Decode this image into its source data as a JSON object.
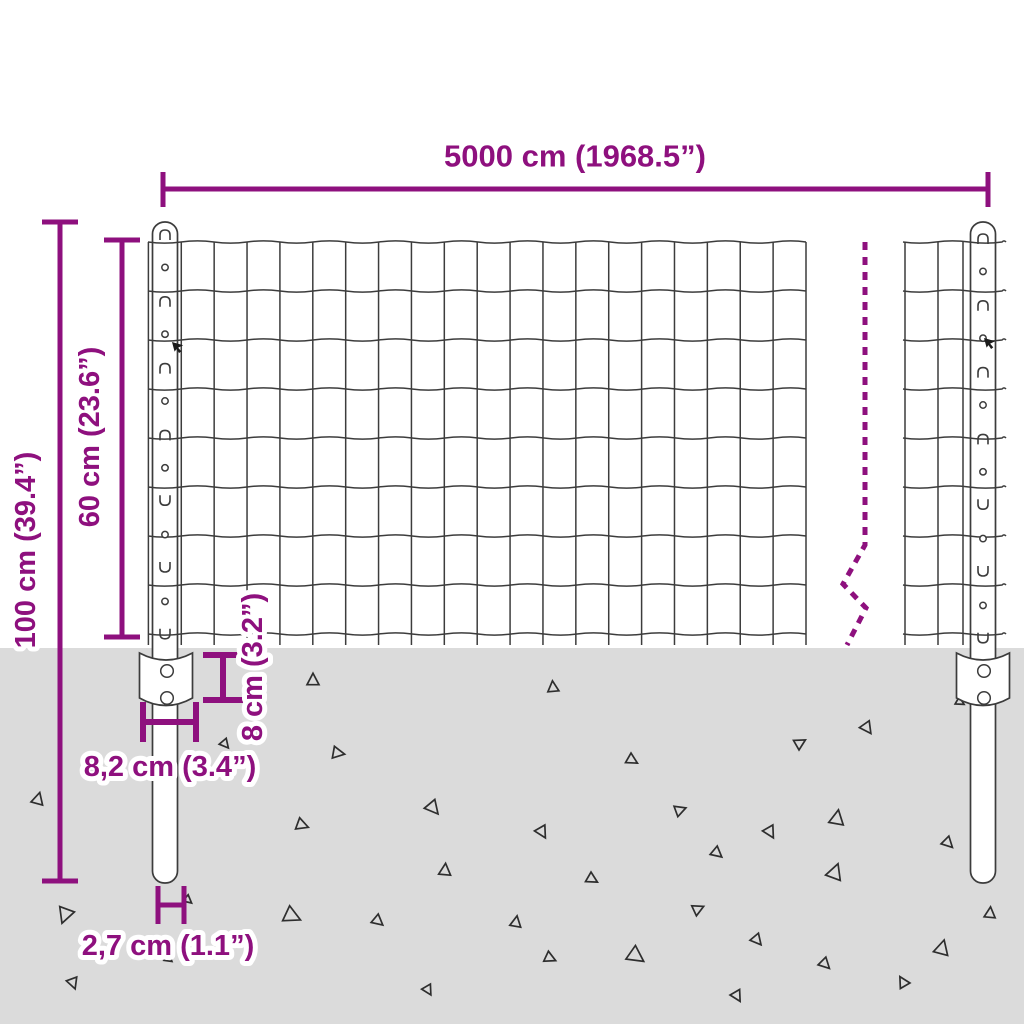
{
  "diagram": {
    "title": "Fence panel with posts — dimension diagram",
    "labels": {
      "width": "5000 cm (1968.5”)",
      "total_height": "100 cm (39.4”)",
      "panel_height": "60 cm (23.6”)",
      "anchor_height": "8 cm (3.2”)",
      "anchor_width": "8,2 cm (3.4”)",
      "post_diameter": "2,7 cm (1.1”)"
    },
    "values": {
      "width": {
        "cm": "5000",
        "inches": "1968.5"
      },
      "total_height": {
        "cm": "100",
        "inches": "39.4"
      },
      "panel_height": {
        "cm": "60",
        "inches": "23.6"
      },
      "anchor_height": {
        "cm": "8",
        "inches": "3.2"
      },
      "anchor_width": {
        "cm": "8,2",
        "inches": "3.4"
      },
      "post_diameter": {
        "cm": "2,7",
        "inches": "1.1"
      }
    },
    "colors": {
      "accent": "#8E107E",
      "ground": "#DBDBDB",
      "line": "#3C3C3C"
    }
  }
}
